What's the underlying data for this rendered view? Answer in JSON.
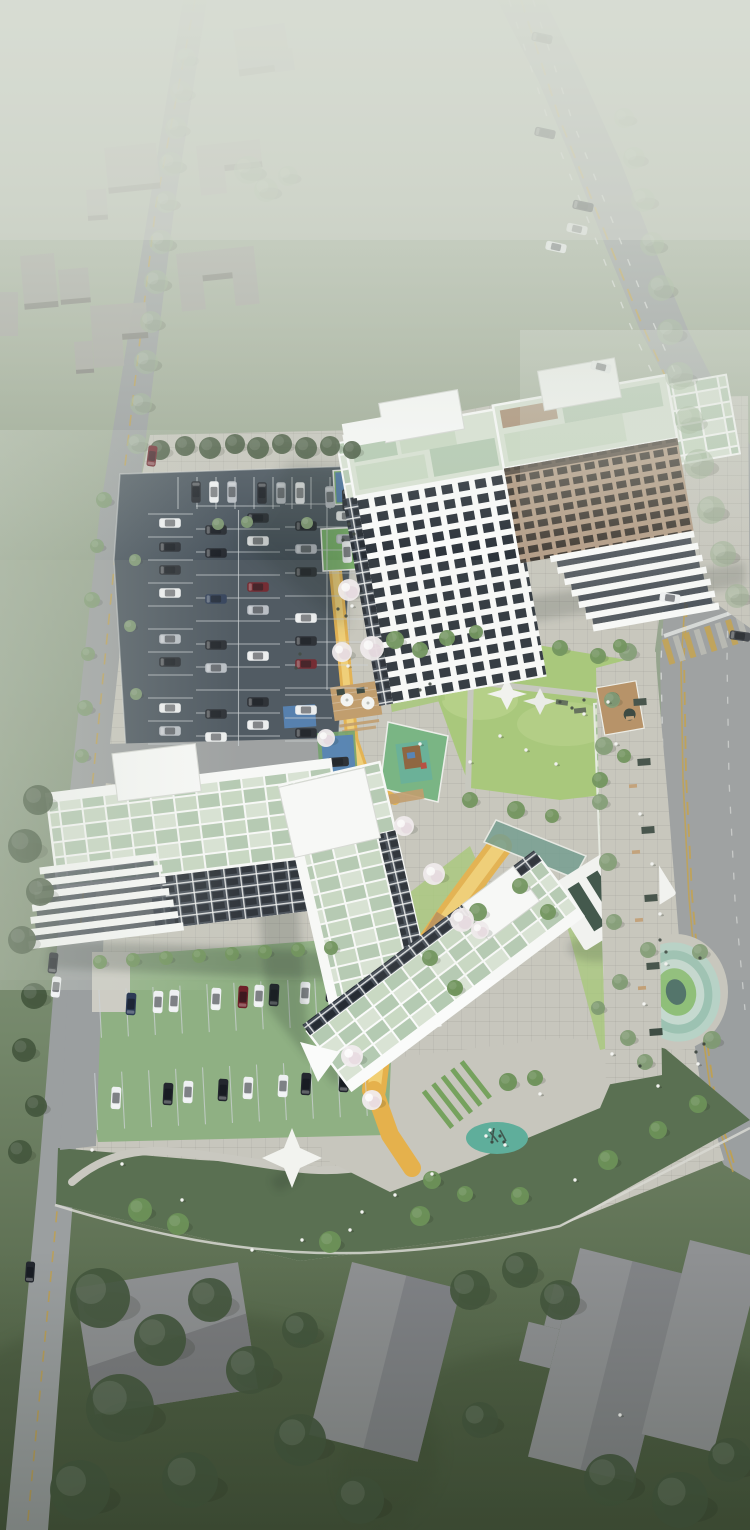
{
  "meta": {
    "type": "architectural-aerial-render",
    "subject": "Bird's-eye 3D rendering of an apartment complex site with four residential buildings, parking lots, landscaped courtyard and surrounding roads",
    "atmosphere": "strong white haze/fog over upper half, dark wooded ground at bottom",
    "notable_features": [
      "main highway with tree row (right)",
      "local road (left)",
      "surface parking lot with cars",
      "grass-paver parking rows (south)",
      "courtyard lawn with shade sails",
      "children playground",
      "wood deck with parasols",
      "yellow walking paths with cherry-blossom trees",
      "linear trellis walk with white pergola",
      "oval sunken garden",
      "teal play circle",
      "white event canopy",
      "gray massing houses (top-left)",
      "warehouse roofs (bottom)"
    ]
  },
  "palette": {
    "bg_top": "#b6bfb1",
    "bg_upper": "#a5b09c",
    "bg_mid": "#90a088",
    "bg_lower": "#74876a",
    "bg_bottom": "#48583e",
    "fog": "#d8ded4",
    "road": "#9b9fa0",
    "asphalt": "#47525c",
    "stall_line": "#ced3d7",
    "sidewalk": "#c7c6bd",
    "lane_yellow": "#c4a045",
    "lane_white": "#e9ebe9",
    "lawn": "#a6c877",
    "lawn_light": "#c0d791",
    "slope": "#5a7052",
    "turf_parking": "#8fb083",
    "hedge": "#76a25e",
    "path_yellow": "#e5b14c",
    "path_yellow_light": "#f1cf74",
    "deck_wood": "#c09a68",
    "wood_planter": "#b58f62",
    "mat_blue": "#4f7fb5",
    "mat_teal": "#5fae9b",
    "oval_ring1": "#b7d2c6",
    "oval_ring2": "#9cc2b2",
    "oval_ring3": "#c5d9cf",
    "oval_lawn": "#8fbf79",
    "oval_pit": "#54756b",
    "tower_white": "#f3f4f5",
    "tower_glass": "#2c333b",
    "tower_tan": "#b29a83",
    "glass_dark": "#3b342d",
    "roof_pale": "#d9e3d4",
    "roof_green": "#b4cab2",
    "roof_green2": "#c9d9c3",
    "parapet": "#fafbfa",
    "facade_dark": "#454d57",
    "glass_canopy": "#6f9b8d",
    "building_gray": "#a9a8a3",
    "building_side": "#84837e",
    "warehouse": "#8f9193",
    "warehouse_dark": "#75777b",
    "tree_hazy": "#9db394",
    "tree_street": "#7f9a72",
    "tree_court": "#6d9159",
    "tree_dark": "#44573e",
    "blossom": "#f1ecee",
    "shadow": "#232e28",
    "people": "#f3f4f1"
  },
  "buildings": [
    {
      "id": "tower-a",
      "style": "white grid facade tower, green panel roof, two white rooftop bulkheads"
    },
    {
      "id": "slab-b",
      "style": "tan brick slab with window grid and stepped white terraces on the street end"
    },
    {
      "id": "terrace-slab-c",
      "style": "low slab with stepped white terraces west end, dark gridded south facade, green roof"
    },
    {
      "id": "chevron-d",
      "style": "V-shaped building, celadon glass roof planks, white parapets"
    }
  ],
  "cars": {
    "colors": [
      "#23272e",
      "#eef0f2",
      "#b9bec5",
      "#6e2129",
      "#2c3b55",
      "#3c4046"
    ],
    "scales": {
      "roads": 1.3,
      "lot": 1.35,
      "green": 1.4
    },
    "roads": [
      [
        542,
        38,
        12,
        0
      ],
      [
        545,
        133,
        12,
        0
      ],
      [
        583,
        206,
        12,
        0
      ],
      [
        577,
        229,
        12,
        1
      ],
      [
        556,
        247,
        12,
        1
      ],
      [
        601,
        367,
        14,
        1
      ],
      [
        670,
        598,
        8,
        1
      ],
      [
        740,
        636,
        8,
        5
      ],
      [
        152,
        456,
        -83,
        3
      ],
      [
        53,
        963,
        -84,
        0
      ],
      [
        56,
        987,
        -84,
        1
      ],
      [
        30,
        1272,
        -86,
        0
      ]
    ],
    "lot": [
      [
        196,
        492,
        90,
        0
      ],
      [
        214,
        492,
        90,
        1
      ],
      [
        232,
        492,
        90,
        2
      ],
      [
        262,
        493,
        90,
        0
      ],
      [
        281,
        493,
        90,
        2
      ],
      [
        300,
        493,
        90,
        1
      ],
      [
        330,
        497,
        88,
        2
      ],
      [
        347,
        500,
        88,
        0
      ],
      [
        170,
        523,
        0,
        1
      ],
      [
        170,
        547,
        0,
        0
      ],
      [
        170,
        570,
        0,
        0
      ],
      [
        170,
        593,
        0,
        1
      ],
      [
        170,
        639,
        0,
        2
      ],
      [
        170,
        662,
        0,
        0
      ],
      [
        170,
        708,
        0,
        1
      ],
      [
        170,
        731,
        0,
        2
      ],
      [
        216,
        530,
        0,
        0
      ],
      [
        216,
        553,
        0,
        0
      ],
      [
        216,
        599,
        0,
        4
      ],
      [
        216,
        645,
        0,
        0
      ],
      [
        216,
        668,
        0,
        2
      ],
      [
        216,
        714,
        0,
        0
      ],
      [
        216,
        737,
        0,
        1
      ],
      [
        258,
        518,
        0,
        0
      ],
      [
        258,
        541,
        0,
        1
      ],
      [
        258,
        587,
        0,
        3
      ],
      [
        258,
        610,
        0,
        2
      ],
      [
        258,
        656,
        0,
        1
      ],
      [
        258,
        702,
        0,
        0
      ],
      [
        258,
        725,
        0,
        1
      ],
      [
        306,
        526,
        0,
        0
      ],
      [
        306,
        549,
        0,
        2
      ],
      [
        306,
        572,
        0,
        0
      ],
      [
        306,
        618,
        0,
        1
      ],
      [
        306,
        641,
        0,
        0
      ],
      [
        306,
        664,
        0,
        3
      ],
      [
        306,
        710,
        0,
        1
      ],
      [
        306,
        733,
        0,
        0
      ],
      [
        347,
        516,
        0,
        1
      ],
      [
        347,
        539,
        0,
        2
      ],
      [
        347,
        552,
        88,
        1
      ],
      [
        338,
        762,
        -4,
        0
      ]
    ],
    "green": [
      [
        131,
        1004,
        -87,
        4
      ],
      [
        158,
        1002,
        -87,
        1
      ],
      [
        174,
        1001,
        -87,
        1
      ],
      [
        216,
        999,
        -87,
        1
      ],
      [
        243,
        997,
        -87,
        3
      ],
      [
        259,
        996,
        -87,
        1
      ],
      [
        274,
        995,
        -87,
        0
      ],
      [
        305,
        993,
        -87,
        1
      ],
      [
        331,
        991,
        -87,
        0
      ],
      [
        116,
        1098,
        -87,
        1
      ],
      [
        168,
        1094,
        -87,
        0
      ],
      [
        188,
        1092,
        -87,
        1
      ],
      [
        223,
        1090,
        -87,
        0
      ],
      [
        248,
        1088,
        -87,
        1
      ],
      [
        283,
        1086,
        -87,
        1
      ],
      [
        306,
        1084,
        -87,
        0
      ],
      [
        344,
        1081,
        -87,
        0
      ]
    ]
  },
  "trees": {
    "hazy": [
      [
        186,
        58,
        10
      ],
      [
        181,
        92,
        11
      ],
      [
        176,
        128,
        11
      ],
      [
        171,
        164,
        12
      ],
      [
        166,
        202,
        11
      ],
      [
        161,
        242,
        12
      ],
      [
        156,
        282,
        12
      ],
      [
        151,
        322,
        11
      ],
      [
        146,
        362,
        12
      ],
      [
        141,
        404,
        11
      ],
      [
        137,
        444,
        10
      ],
      [
        248,
        170,
        14
      ],
      [
        266,
        190,
        12
      ],
      [
        288,
        176,
        10
      ],
      [
        624,
        118,
        10
      ],
      [
        634,
        158,
        11
      ],
      [
        643,
        200,
        12
      ],
      [
        652,
        244,
        12
      ],
      [
        661,
        288,
        13
      ],
      [
        670,
        332,
        13
      ],
      [
        679,
        376,
        14
      ],
      [
        689,
        420,
        14
      ],
      [
        699,
        464,
        15
      ],
      [
        711,
        510,
        14
      ],
      [
        723,
        554,
        13
      ],
      [
        737,
        596,
        12
      ]
    ],
    "street": [
      [
        104,
        500,
        8
      ],
      [
        97,
        546,
        7
      ],
      [
        92,
        600,
        8
      ],
      [
        88,
        654,
        7
      ],
      [
        85,
        708,
        8
      ],
      [
        82,
        756,
        7
      ],
      [
        628,
        652,
        9
      ],
      [
        612,
        700,
        8
      ],
      [
        604,
        746,
        9
      ],
      [
        600,
        802,
        8
      ],
      [
        608,
        862,
        9
      ],
      [
        614,
        922,
        8
      ],
      [
        620,
        982,
        8
      ],
      [
        628,
        1038,
        8
      ],
      [
        648,
        950,
        8
      ],
      [
        700,
        952,
        8
      ],
      [
        712,
        1040,
        9
      ],
      [
        645,
        1062,
        8
      ],
      [
        598,
        1008,
        7
      ],
      [
        135,
        560,
        6
      ],
      [
        130,
        626,
        6
      ],
      [
        136,
        694,
        6
      ],
      [
        218,
        524,
        6
      ],
      [
        247,
        522,
        6
      ],
      [
        307,
        523,
        6
      ]
    ],
    "court": [
      [
        395,
        640,
        9
      ],
      [
        420,
        650,
        8
      ],
      [
        447,
        638,
        8
      ],
      [
        476,
        632,
        7
      ],
      [
        560,
        648,
        8
      ],
      [
        598,
        656,
        8
      ],
      [
        620,
        646,
        7
      ],
      [
        600,
        780,
        8
      ],
      [
        624,
        756,
        7
      ],
      [
        470,
        800,
        8
      ],
      [
        516,
        810,
        9
      ],
      [
        552,
        816,
        7
      ],
      [
        478,
        912,
        9
      ],
      [
        520,
        886,
        8
      ],
      [
        548,
        912,
        8
      ],
      [
        430,
        958,
        8
      ],
      [
        455,
        988,
        8
      ],
      [
        508,
        1082,
        9
      ],
      [
        535,
        1078,
        8
      ],
      [
        432,
        1180,
        9
      ],
      [
        465,
        1194,
        8
      ],
      [
        140,
        1210,
        12
      ],
      [
        178,
        1224,
        11
      ],
      [
        330,
        1242,
        11
      ],
      [
        420,
        1216,
        10
      ],
      [
        520,
        1196,
        9
      ],
      [
        608,
        1160,
        10
      ],
      [
        658,
        1130,
        9
      ],
      [
        698,
        1104,
        9
      ],
      [
        100,
        962,
        7
      ],
      [
        133,
        960,
        7
      ],
      [
        166,
        958,
        7
      ],
      [
        199,
        956,
        7
      ],
      [
        232,
        954,
        7
      ],
      [
        265,
        952,
        7
      ],
      [
        298,
        950,
        7
      ],
      [
        331,
        948,
        7
      ]
    ],
    "dark": [
      [
        100,
        1298,
        30
      ],
      [
        160,
        1340,
        26
      ],
      [
        120,
        1408,
        34
      ],
      [
        210,
        1300,
        22
      ],
      [
        250,
        1370,
        24
      ],
      [
        80,
        1490,
        30
      ],
      [
        190,
        1480,
        28
      ],
      [
        300,
        1440,
        26
      ],
      [
        360,
        1500,
        24
      ],
      [
        470,
        1290,
        20
      ],
      [
        520,
        1270,
        18
      ],
      [
        560,
        1300,
        20
      ],
      [
        610,
        1480,
        26
      ],
      [
        680,
        1500,
        28
      ],
      [
        730,
        1460,
        22
      ],
      [
        480,
        1420,
        18
      ],
      [
        300,
        1330,
        18
      ],
      [
        38,
        800,
        15
      ],
      [
        25,
        846,
        17
      ],
      [
        40,
        892,
        14
      ],
      [
        22,
        940,
        14
      ],
      [
        34,
        996,
        13
      ],
      [
        24,
        1050,
        12
      ],
      [
        36,
        1106,
        11
      ],
      [
        20,
        1152,
        12
      ],
      [
        160,
        450,
        10
      ],
      [
        185,
        446,
        10
      ],
      [
        210,
        448,
        11
      ],
      [
        235,
        444,
        10
      ],
      [
        258,
        448,
        11
      ],
      [
        282,
        444,
        10
      ],
      [
        306,
        448,
        11
      ],
      [
        330,
        446,
        10
      ],
      [
        352,
        450,
        9
      ]
    ],
    "blossom": [
      [
        349,
        590,
        11
      ],
      [
        342,
        652,
        10
      ],
      [
        326,
        738,
        9
      ],
      [
        372,
        648,
        12
      ],
      [
        404,
        826,
        10
      ],
      [
        434,
        874,
        11
      ],
      [
        462,
        920,
        12
      ],
      [
        352,
        1056,
        11
      ],
      [
        372,
        1100,
        10
      ],
      [
        480,
        930,
        9
      ]
    ]
  },
  "people": [
    [
      352,
      606
    ],
    [
      348,
      666
    ],
    [
      420,
      744
    ],
    [
      470,
      762
    ],
    [
      500,
      736
    ],
    [
      526,
      750
    ],
    [
      556,
      764
    ],
    [
      584,
      714
    ],
    [
      608,
      702
    ],
    [
      616,
      744
    ],
    [
      640,
      814
    ],
    [
      652,
      864
    ],
    [
      660,
      914
    ],
    [
      666,
      964
    ],
    [
      644,
      1004
    ],
    [
      612,
      1054
    ],
    [
      540,
      1094
    ],
    [
      486,
      1136
    ],
    [
      432,
      1174
    ],
    [
      362,
      1212
    ],
    [
      302,
      1240
    ],
    [
      252,
      1250
    ],
    [
      182,
      1200
    ],
    [
      122,
      1164
    ],
    [
      92,
      1150
    ],
    [
      658,
      1086
    ],
    [
      698,
      1064
    ],
    [
      505,
      1145
    ],
    [
      490,
      1130
    ],
    [
      350,
      1230
    ],
    [
      395,
      1195
    ],
    [
      575,
      1180
    ],
    [
      620,
      1415
    ]
  ],
  "equipment_dots": [
    [
      349,
      524
    ],
    [
      354,
      534
    ],
    [
      343,
      540
    ],
    [
      338,
      609
    ],
    [
      346,
      616
    ],
    [
      300,
      654
    ],
    [
      296,
      668
    ],
    [
      420,
      690
    ],
    [
      430,
      684
    ],
    [
      500,
      1136
    ],
    [
      492,
      1142
    ],
    [
      504,
      1142
    ],
    [
      560,
      702
    ],
    [
      572,
      708
    ],
    [
      584,
      700
    ],
    [
      660,
      940
    ],
    [
      666,
      952
    ],
    [
      700,
      958
    ],
    [
      704,
      1044
    ],
    [
      696,
      1052
    ],
    [
      640,
      1066
    ]
  ],
  "street_furniture": {
    "planters": [
      [
        640,
        702
      ],
      [
        644,
        762
      ],
      [
        648,
        830
      ],
      [
        651,
        898
      ],
      [
        653,
        966
      ],
      [
        656,
        1032
      ]
    ],
    "benches": [
      [
        630,
        718
      ],
      [
        633,
        786
      ],
      [
        636,
        852
      ],
      [
        639,
        920
      ],
      [
        642,
        988
      ]
    ]
  },
  "parking": {
    "rows": [
      {
        "dir": "v",
        "x0": 178,
        "step": 19,
        "n": 10,
        "y0": 477,
        "y1": 509
      },
      {
        "dir": "h",
        "y0": 514,
        "step": 23,
        "n": 11,
        "x0": 148,
        "x1": 193
      },
      {
        "dir": "h",
        "y0": 506,
        "step": 23,
        "n": 11,
        "x0": 196,
        "x1": 280
      },
      {
        "dir": "h",
        "y0": 504,
        "step": 23,
        "n": 9,
        "x0": 285,
        "x1": 368
      },
      {
        "dir": "h",
        "y0": 695,
        "step": 23,
        "n": 3,
        "x0": 285,
        "x1": 332
      },
      {
        "dir": "v",
        "x0": 100,
        "step": 27,
        "n": 11,
        "y0": 983,
        "y1": 1031,
        "rot": -3,
        "cx": 230,
        "cy": 1007
      },
      {
        "dir": "v",
        "x0": 96,
        "step": 27,
        "n": 11,
        "y0": 1066,
        "y1": 1123,
        "rot": -3,
        "cx": 230,
        "cy": 1095
      }
    ],
    "dividers": [
      [
        238.5,
        510,
        238.5,
        746
      ],
      [
        327,
        500,
        327,
        690
      ]
    ]
  },
  "counts": {
    "cars_total": 71,
    "residential_buildings": 4,
    "shade_sails": 2,
    "parasols": 2
  }
}
